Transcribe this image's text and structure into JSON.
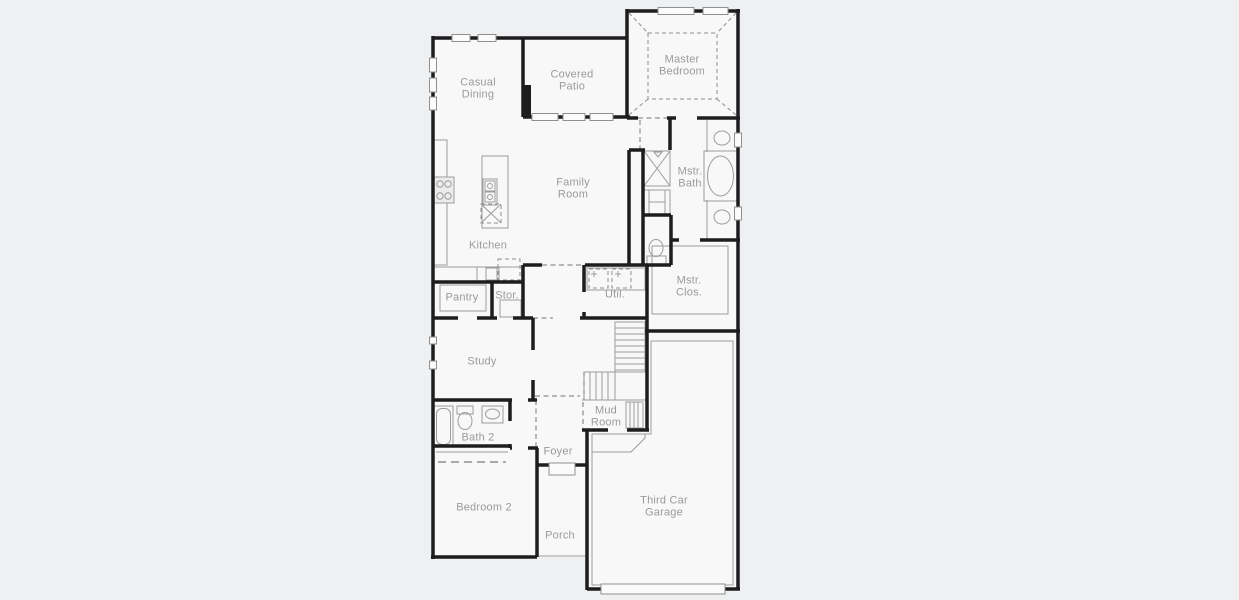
{
  "colors": {
    "background": "#eff0f1",
    "floor": "#f8f8f9",
    "wall": "#1d1d1f",
    "line": "#9c9c9c",
    "dash": "#8e8e8e",
    "label": "#9a9a9a"
  },
  "rooms": {
    "casual_dining": "Casual\nDining",
    "covered_patio": "Covered\nPatio",
    "master_bedroom": "Master\nBedroom",
    "family_room": "Family\nRoom",
    "kitchen": "Kitchen",
    "mstr_bath": "Mstr.\nBath",
    "mstr_clos": "Mstr.\nClos.",
    "pantry": "Pantry",
    "stor": "Stor.",
    "util": "Util.",
    "study": "Study",
    "mud_room": "Mud\nRoom",
    "bath_2": "Bath 2",
    "foyer": "Foyer",
    "bedroom_2": "Bedroom 2",
    "porch": "Porch",
    "third_car_garage": "Third Car\nGarage"
  }
}
